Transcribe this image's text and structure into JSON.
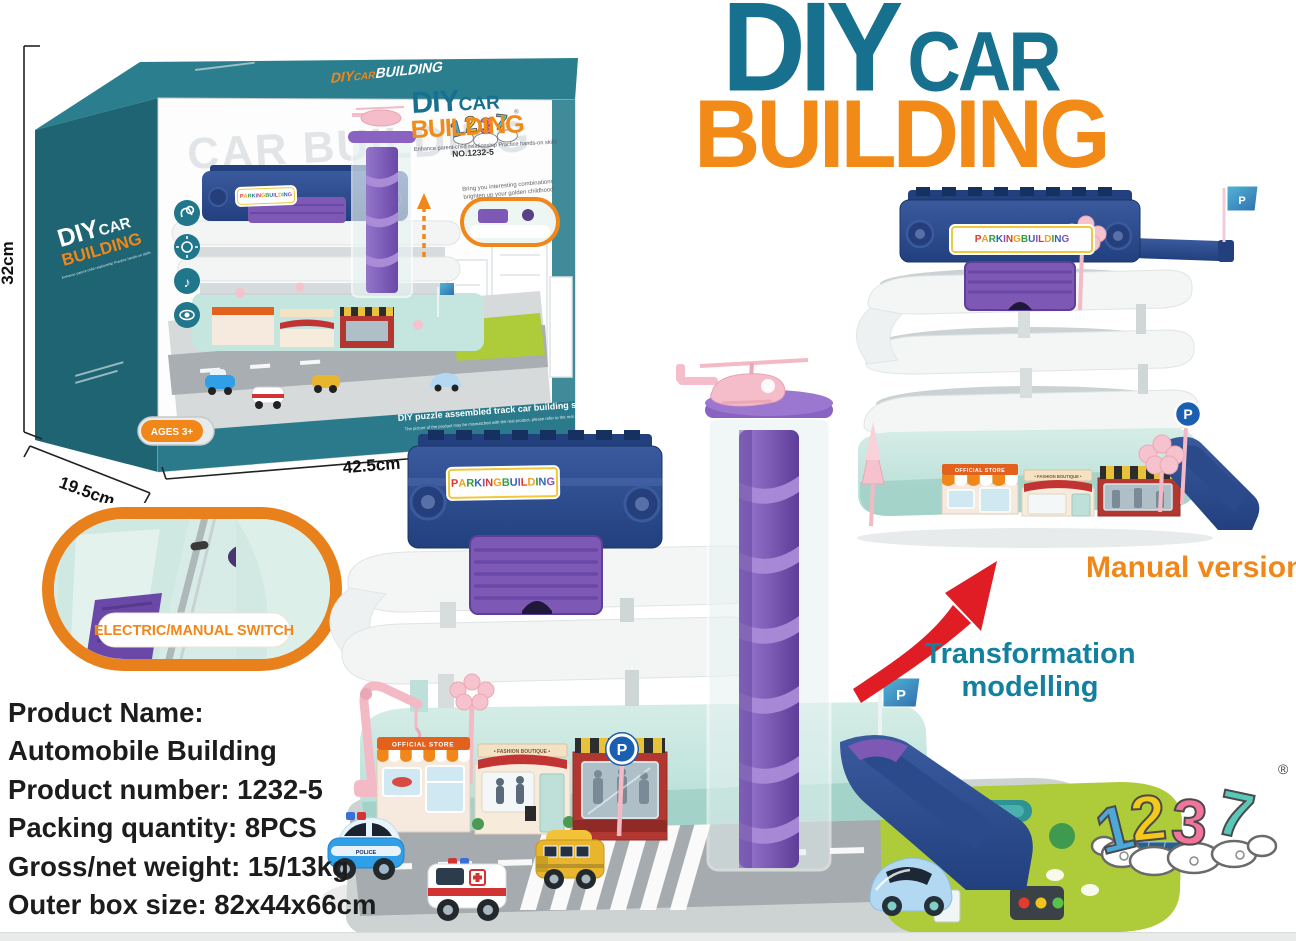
{
  "header": {
    "diy": "DIY",
    "car": "CAR",
    "building": "BUILDING"
  },
  "box": {
    "top_diy": "DIY",
    "top_car": "CAR",
    "top_building": "BUILDING",
    "side": {
      "diy": "DIY",
      "car": "CAR",
      "building": "BUILDING",
      "tagline": "Enhance parent-child relationship  Practice hands-on skills"
    },
    "front": {
      "brand_reg": "®",
      "model_no": "NO.1232-5",
      "watermark": "CAR BUILDING",
      "diy": "DIY",
      "car": "CAR",
      "building": "BUILDING",
      "tagline": "Enhance parent-child relationship    Practice hands-on skills",
      "promo1": "Bring you interesting combinations",
      "promo2": "brighten up your golden childhood",
      "series": "DIY puzzle assembled track car building series",
      "series_fine": "The picture of the product may be mismatched with the real product, please refer to the real product",
      "ages": "AGES 3+",
      "sign": "PARKING BUILDING"
    },
    "dims": {
      "height": "32cm",
      "depth": "19.5cm",
      "width": "42.5cm"
    }
  },
  "callout": {
    "label": "ELECTRIC/MANUAL SWITCH"
  },
  "toy": {
    "sign": "PARKING BUILDING",
    "shop_official": "OFFICIAL STORE",
    "shop_fashion": "• FASHION BOUTIQUE •",
    "parking": "P",
    "police": "POLICE"
  },
  "annotations": {
    "manual_version": "Manual version",
    "transform1": "Transformation",
    "transform2": "modelling"
  },
  "product_info": {
    "lines": [
      "Product Name:",
      "Automobile Building",
      "Product number: 1232-5",
      "Packing quantity: 8PCS",
      "Gross/net weight: 15/13kg",
      "Outer box size: 82x44x66cm"
    ]
  },
  "brand": {
    "d1": "1",
    "d2": "2",
    "d3": "3",
    "d4": "7",
    "reg": "®"
  },
  "sign_palette": [
    "#d9382f",
    "#f0a11b",
    "#2f9e45",
    "#2f62b5",
    "#8a4fb5"
  ]
}
